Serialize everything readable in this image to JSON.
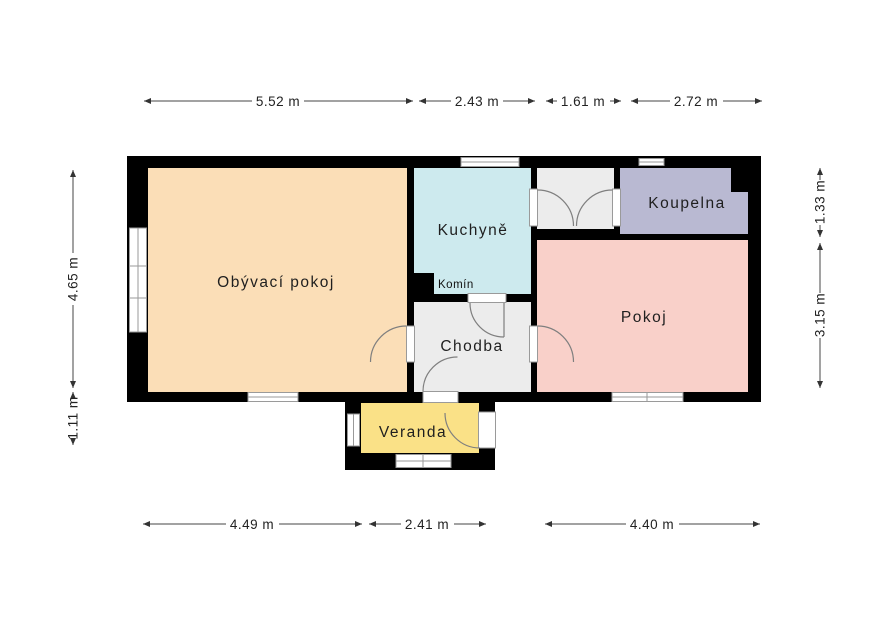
{
  "rooms": {
    "living_room": {
      "label": "Obývací pokoj",
      "color": "#fbdeb7"
    },
    "kitchen": {
      "label": "Kuchyně",
      "color": "#cdeaee"
    },
    "vestibule": {
      "color": "#ececec"
    },
    "bathroom": {
      "label": "Koupelna",
      "color": "#b9b9d2"
    },
    "room": {
      "label": "Pokoj",
      "color": "#f9d0c9"
    },
    "hallway": {
      "label": "Chodba",
      "color": "#ececec"
    },
    "veranda": {
      "label": "Veranda",
      "color": "#fae187"
    },
    "chimney": {
      "label": "Komín",
      "color": "#000000"
    }
  },
  "wall_color": "#000000",
  "dimensions": {
    "top": [
      "5.52 m",
      "2.43 m",
      "1.61 m",
      "2.72 m"
    ],
    "bottom": [
      "4.49 m",
      "2.41 m",
      "4.40 m"
    ],
    "left": [
      "4.65 m",
      "1.11 m"
    ],
    "right": [
      "1.33 m",
      "3.15 m"
    ]
  }
}
